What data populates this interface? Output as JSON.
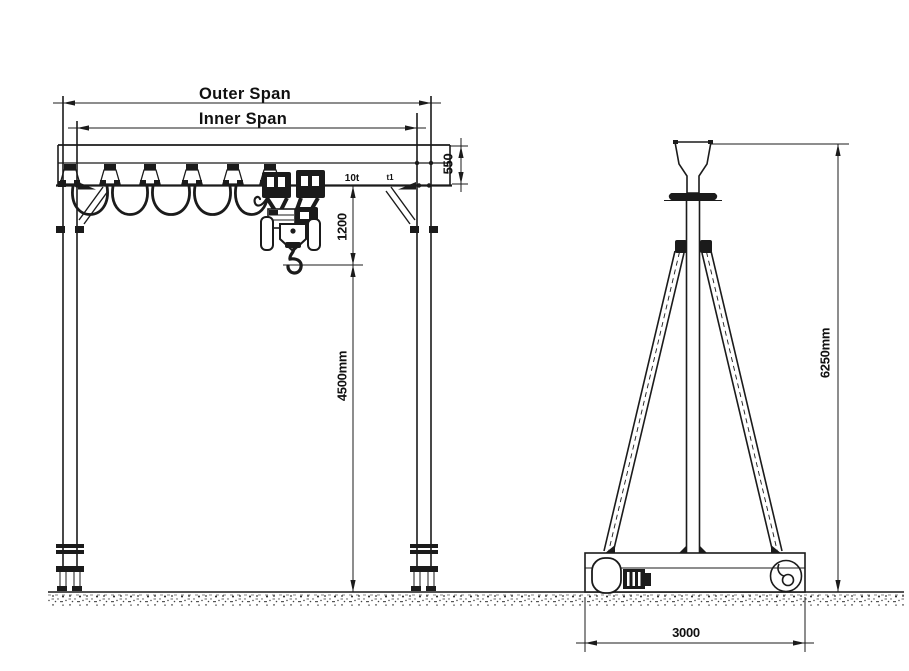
{
  "drawing": {
    "description": "Gantry crane general arrangement drawing with front view and side view",
    "front_view": {
      "outer_span_label": "Outer Span",
      "inner_span_label": "Inner Span",
      "girder_depth_dim": "550",
      "hook_to_rail_dim": "1200",
      "capacity_label": "10t",
      "end_stop_label": "t1",
      "lifting_height_dim": "4500mm"
    },
    "side_view": {
      "overall_height_dim": "6250mm",
      "base_length_dim": "3000"
    },
    "colors": {
      "ink": "#1b1b1b",
      "paper": "#ffffff"
    }
  }
}
